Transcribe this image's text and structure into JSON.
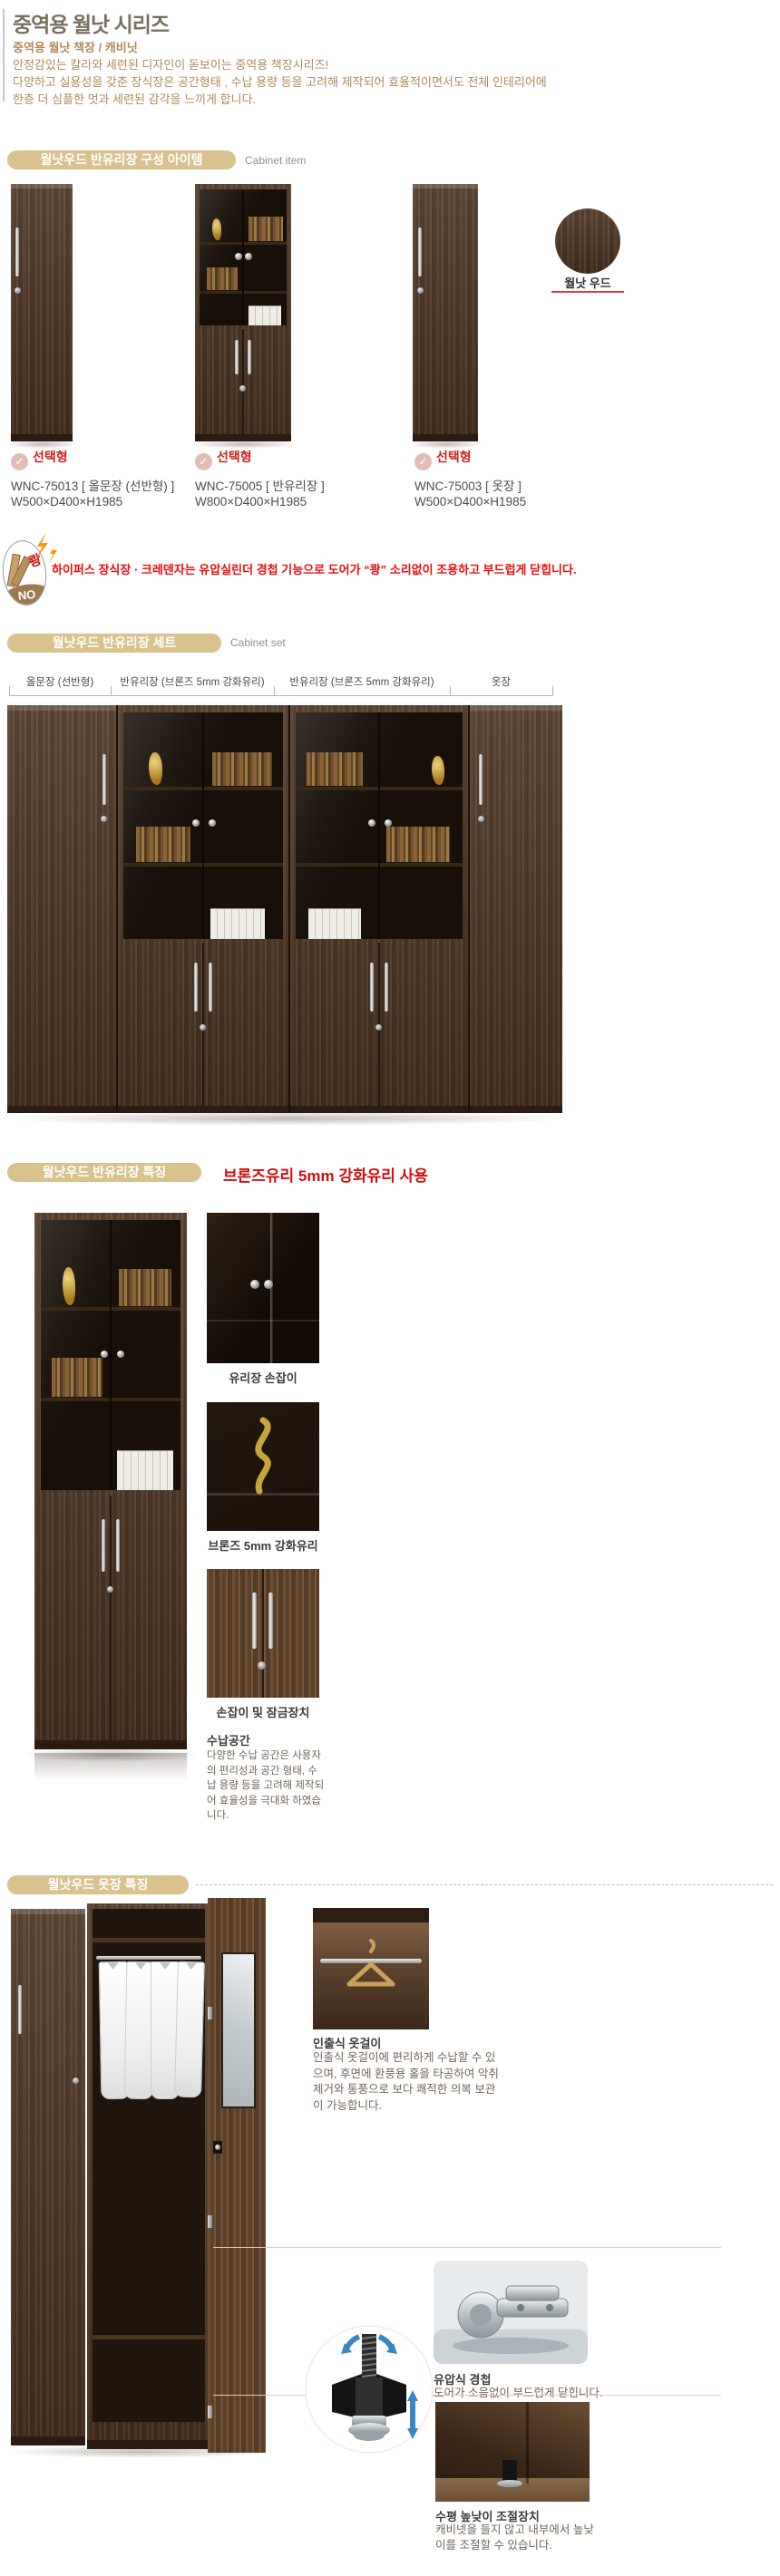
{
  "header": {
    "title": "중역용 월낫 시리즈",
    "subtitle": "중역용 월낫 책장 / 캐비닛",
    "desc1": "안정감있는 칼라와 세련된 디자인이 돋보이는 중역용 책장시리즈!",
    "desc2": "다양하고 실용성을 갖춘 장식장은 공간형태 , 수납 용량 등을 고려해 제작되어 효율적이면서도 전체 인테리어에",
    "desc3": "한층 더 심플한 멋과 세련된 감각을 느끼게 합니다."
  },
  "icons": {
    "check": "✓"
  },
  "section_item": {
    "pill": "월낫우드 반유리장 구성 아이템",
    "side": "Cabinet item"
  },
  "products": [
    {
      "badge": "선택형",
      "model": "WNC-75013  [ 올문장 (선반형) ]",
      "size": "W500×D400×H1985"
    },
    {
      "badge": "선택형",
      "model": "WNC-75005  [ 반유리장 ]",
      "size": "W800×D400×H1985"
    },
    {
      "badge": "선택형",
      "model": "WNC-75003  [ 옷장 ]",
      "size": "W500×D400×H1985"
    }
  ],
  "swatch": {
    "label": "월낫 우드"
  },
  "notice": {
    "boom": "쾅",
    "no": "NO",
    "text": "하이퍼스 장식장 · 크레덴자는 유압실린더 경첩 기능으로 도어가 “쾅” 소리없이 조용하고 부드럽게 닫힙니다."
  },
  "section_set": {
    "pill": "월낫우드 반유리장 세트",
    "side": "Cabinet set",
    "columns": [
      "올문장 (선반형)",
      "반유리장 (브론즈 5mm 강화유리)",
      "반유리장 (브론즈 5mm 강화유리)",
      "옷장"
    ]
  },
  "section_glass": {
    "pill": "월낫우드 반유리장 특징",
    "headline": "브론즈유리 5mm 강화유리 사용",
    "captions": [
      "유리장 손잡이",
      "브론즈 5mm 강화유리",
      "손잡이 및 잠금장치"
    ],
    "storage_title": "수납공간",
    "storage_text": "다양한 수납 공간은 사용자의 편리성과 공간 형태, 수납 용량 등을 고려해 제작되어 효율성을 극대화 하였습니다."
  },
  "section_wardrobe": {
    "pill": "월낫우드 옷장 특징",
    "hanger_title": "인출식 옷걸이",
    "hanger_text": "인출식 옷걸이에 편리하게 수납할 수 있으며, 후면에 환풍용 홀을 타공하여 악취제거와 통풍으로 보다 쾌적한 의복 보관이 가능합니다.",
    "hinge_title": "유압식 경첩",
    "hinge_text": "도어가 소음없이 부드럽게 닫힙니다.",
    "level_title": "수평 높낮이 조절장치",
    "level_text": "캐비넷을 들지 않고 내부에서 높낮이를 조절할 수 있습니다."
  },
  "colors": {
    "pill": "#d9c28d",
    "accent_red": "#e01010",
    "tan_text": "#b18a5c",
    "wood": "#4d3729"
  }
}
